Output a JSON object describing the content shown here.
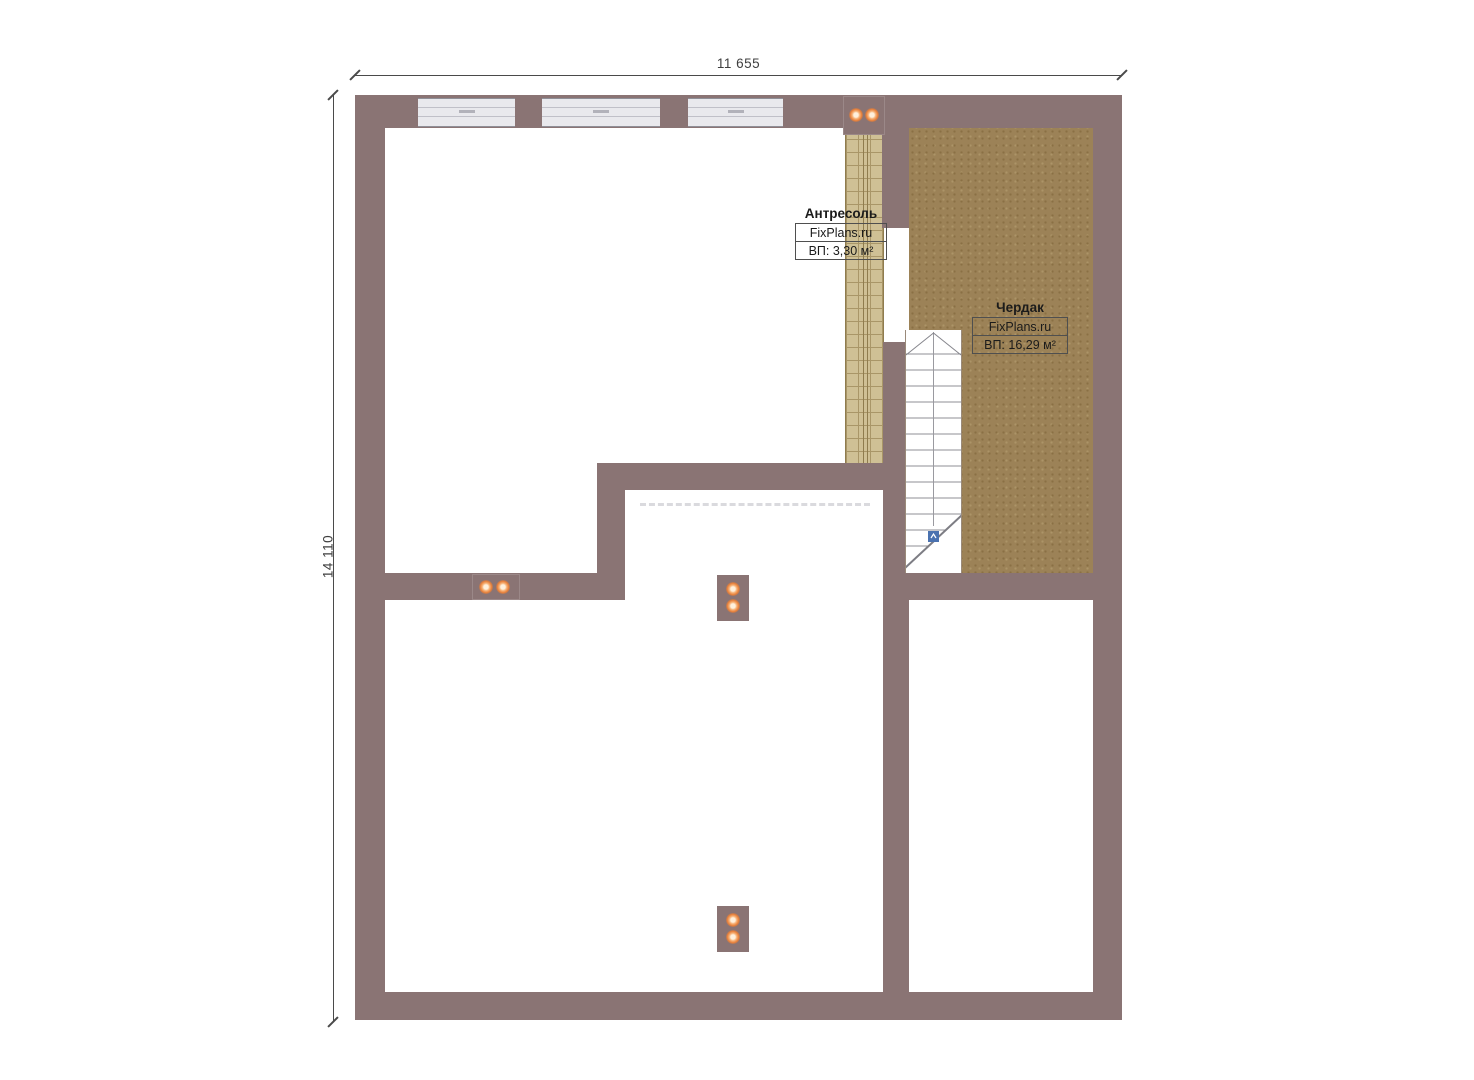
{
  "drawing": {
    "type": "floor-plan",
    "level_hint": "attic / mezzanine level"
  },
  "dimensions": {
    "width_label": "11 655",
    "height_label": "14 110"
  },
  "rooms": [
    {
      "name": "Антресоль",
      "brand": "FixPlans.ru",
      "area_label": "ВП: 3,30 м²"
    },
    {
      "name": "Чердак",
      "brand": "FixPlans.ru",
      "area_label": "ВП: 16,29 м²"
    }
  ],
  "colors": {
    "wall": "#8a7474",
    "mezzanine_floor": "#cfc095",
    "attic_floor": "#9c8257",
    "window_glass": "#e9e9ed",
    "spotlight_orange": "#e8803a",
    "stair_marker_blue": "#4a72b0",
    "dimension_line": "#4a4a4a"
  },
  "icons": {
    "spotlight": "spotlight-icon (orange ceiling light dot)",
    "stair_direction": "stair-direction-marker (blue square)"
  }
}
